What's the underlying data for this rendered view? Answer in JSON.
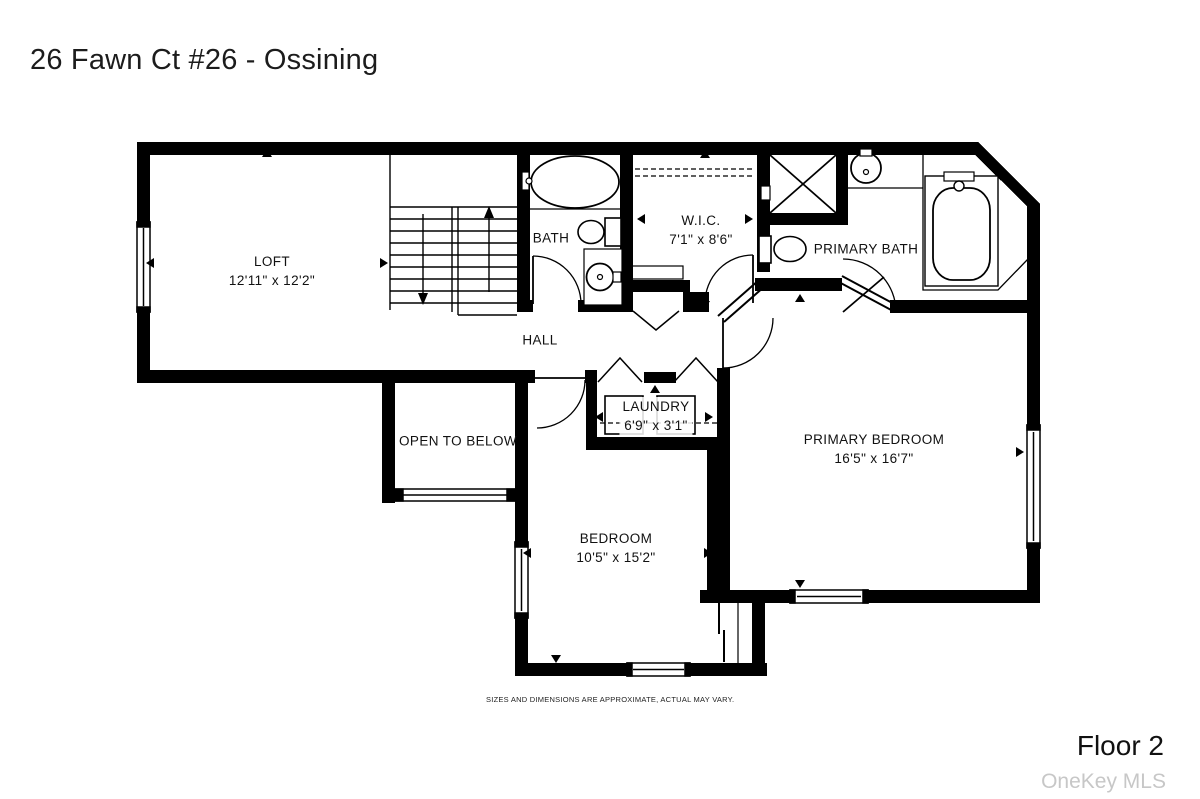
{
  "header": {
    "title": "26 Fawn Ct #26 - Ossining"
  },
  "footer": {
    "floor_label": "Floor 2",
    "watermark": "OneKey MLS",
    "disclaimer": "SIZES AND DIMENSIONS ARE APPROXIMATE, ACTUAL MAY VARY."
  },
  "rooms": {
    "loft": {
      "name": "LOFT",
      "dimensions": "12'11\" x 12'2\""
    },
    "bath": {
      "name": "BATH"
    },
    "wic": {
      "name": "W.I.C.",
      "dimensions": "7'1\" x 8'6\""
    },
    "primary_bath": {
      "name": "PRIMARY BATH"
    },
    "hall": {
      "name": "HALL"
    },
    "open_to_below": {
      "name": "OPEN TO BELOW"
    },
    "laundry": {
      "name": "LAUNDRY",
      "dimensions": "6'9\" x 3'1\""
    },
    "primary_bedroom": {
      "name": "PRIMARY BEDROOM",
      "dimensions": "16'5\" x 16'7\""
    },
    "bedroom": {
      "name": "BEDROOM",
      "dimensions": "10'5\" x 15'2\""
    }
  },
  "colors": {
    "walls": "#000000",
    "background": "#ffffff",
    "watermark_gray": "#c7c7c7"
  }
}
